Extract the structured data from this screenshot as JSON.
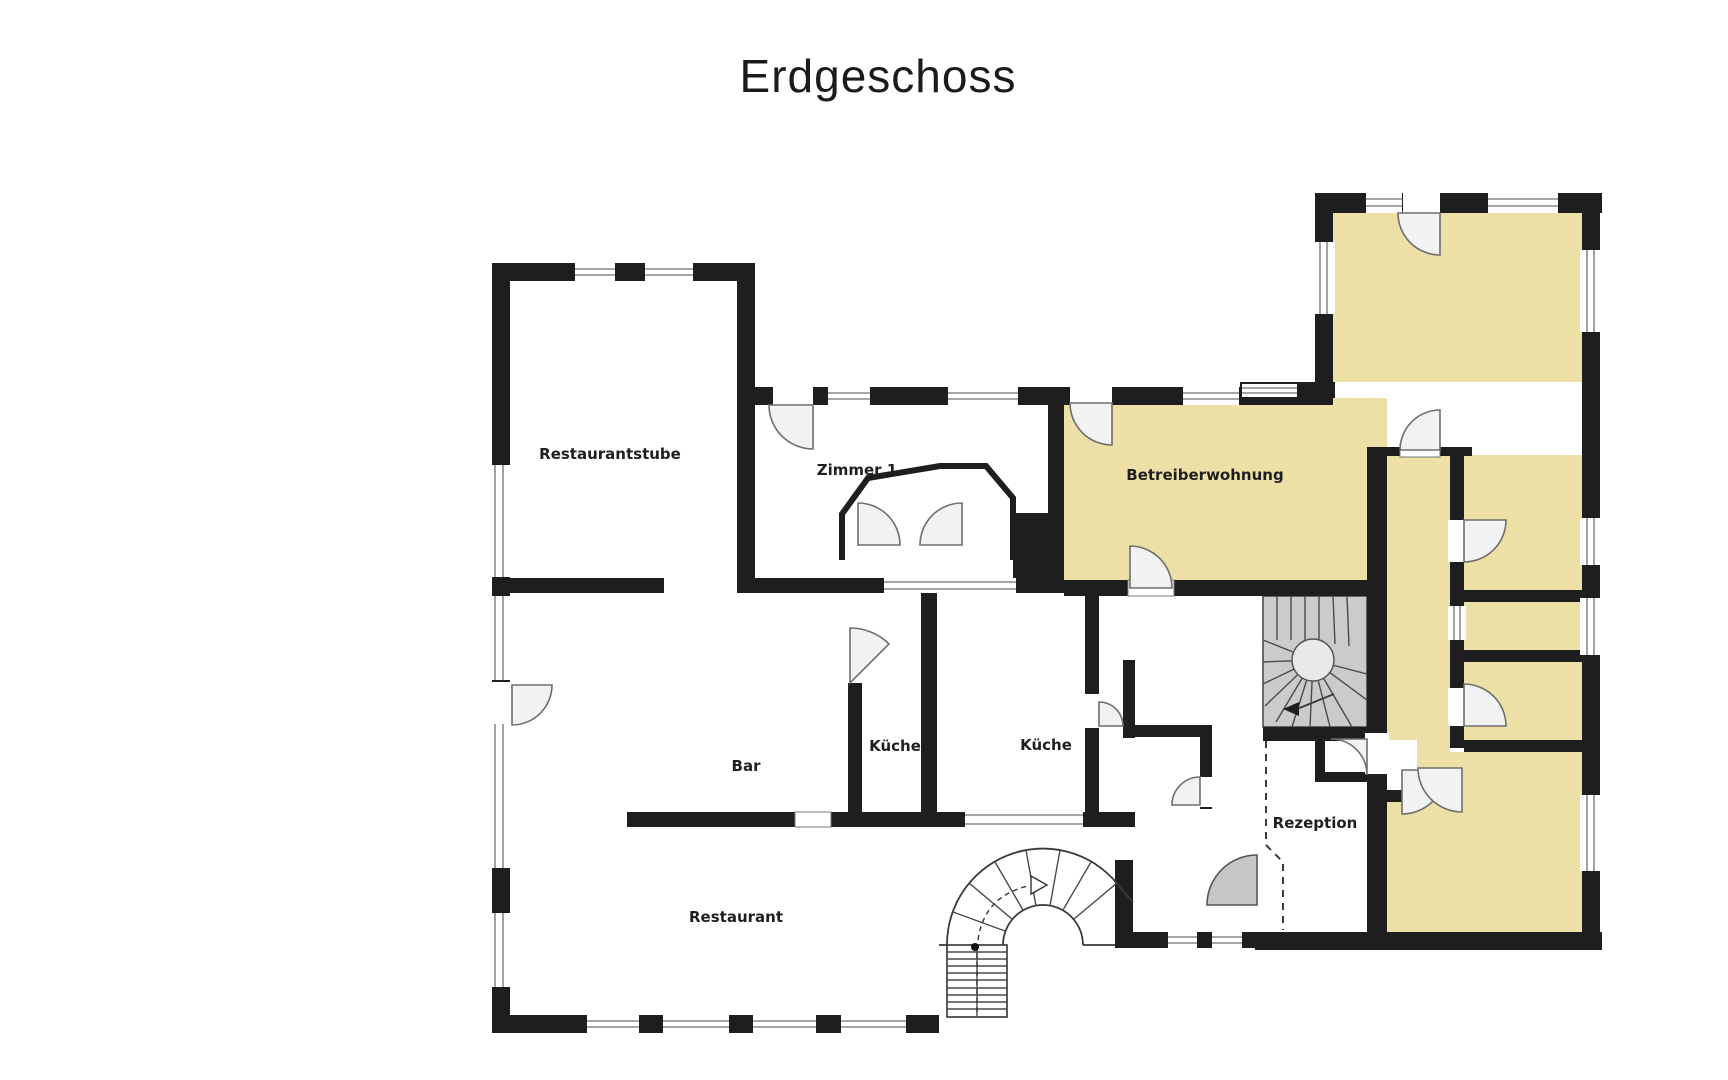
{
  "title": "Erdgeschoss",
  "floor_plan": {
    "rooms": [
      {
        "id": "restaurantstube",
        "label": "Restaurantstube",
        "highlighted": false
      },
      {
        "id": "zimmer-1",
        "label": "Zimmer 1",
        "highlighted": false
      },
      {
        "id": "betreiberwohnung",
        "label": "Betreiberwohnung",
        "highlighted": true
      },
      {
        "id": "bar",
        "label": "Bar",
        "highlighted": false
      },
      {
        "id": "kueche-links",
        "label": "Küche",
        "highlighted": false
      },
      {
        "id": "kueche-rechts",
        "label": "Küche",
        "highlighted": false
      },
      {
        "id": "restaurant",
        "label": "Restaurant",
        "highlighted": false
      },
      {
        "id": "rezeption",
        "label": "Rezeption",
        "highlighted": false
      }
    ],
    "features": {
      "main_stairs": "U-Treppe",
      "spiral_stairs": "Wendeltreppe",
      "entrance": "Eingang"
    },
    "colors": {
      "highlight": "#ece0a6",
      "wall": "#1e1e1e",
      "stair_fill": "#cbcbcb",
      "door_fill": "#f2f2f2",
      "entrance_door_fill": "#c6c6c6"
    }
  }
}
